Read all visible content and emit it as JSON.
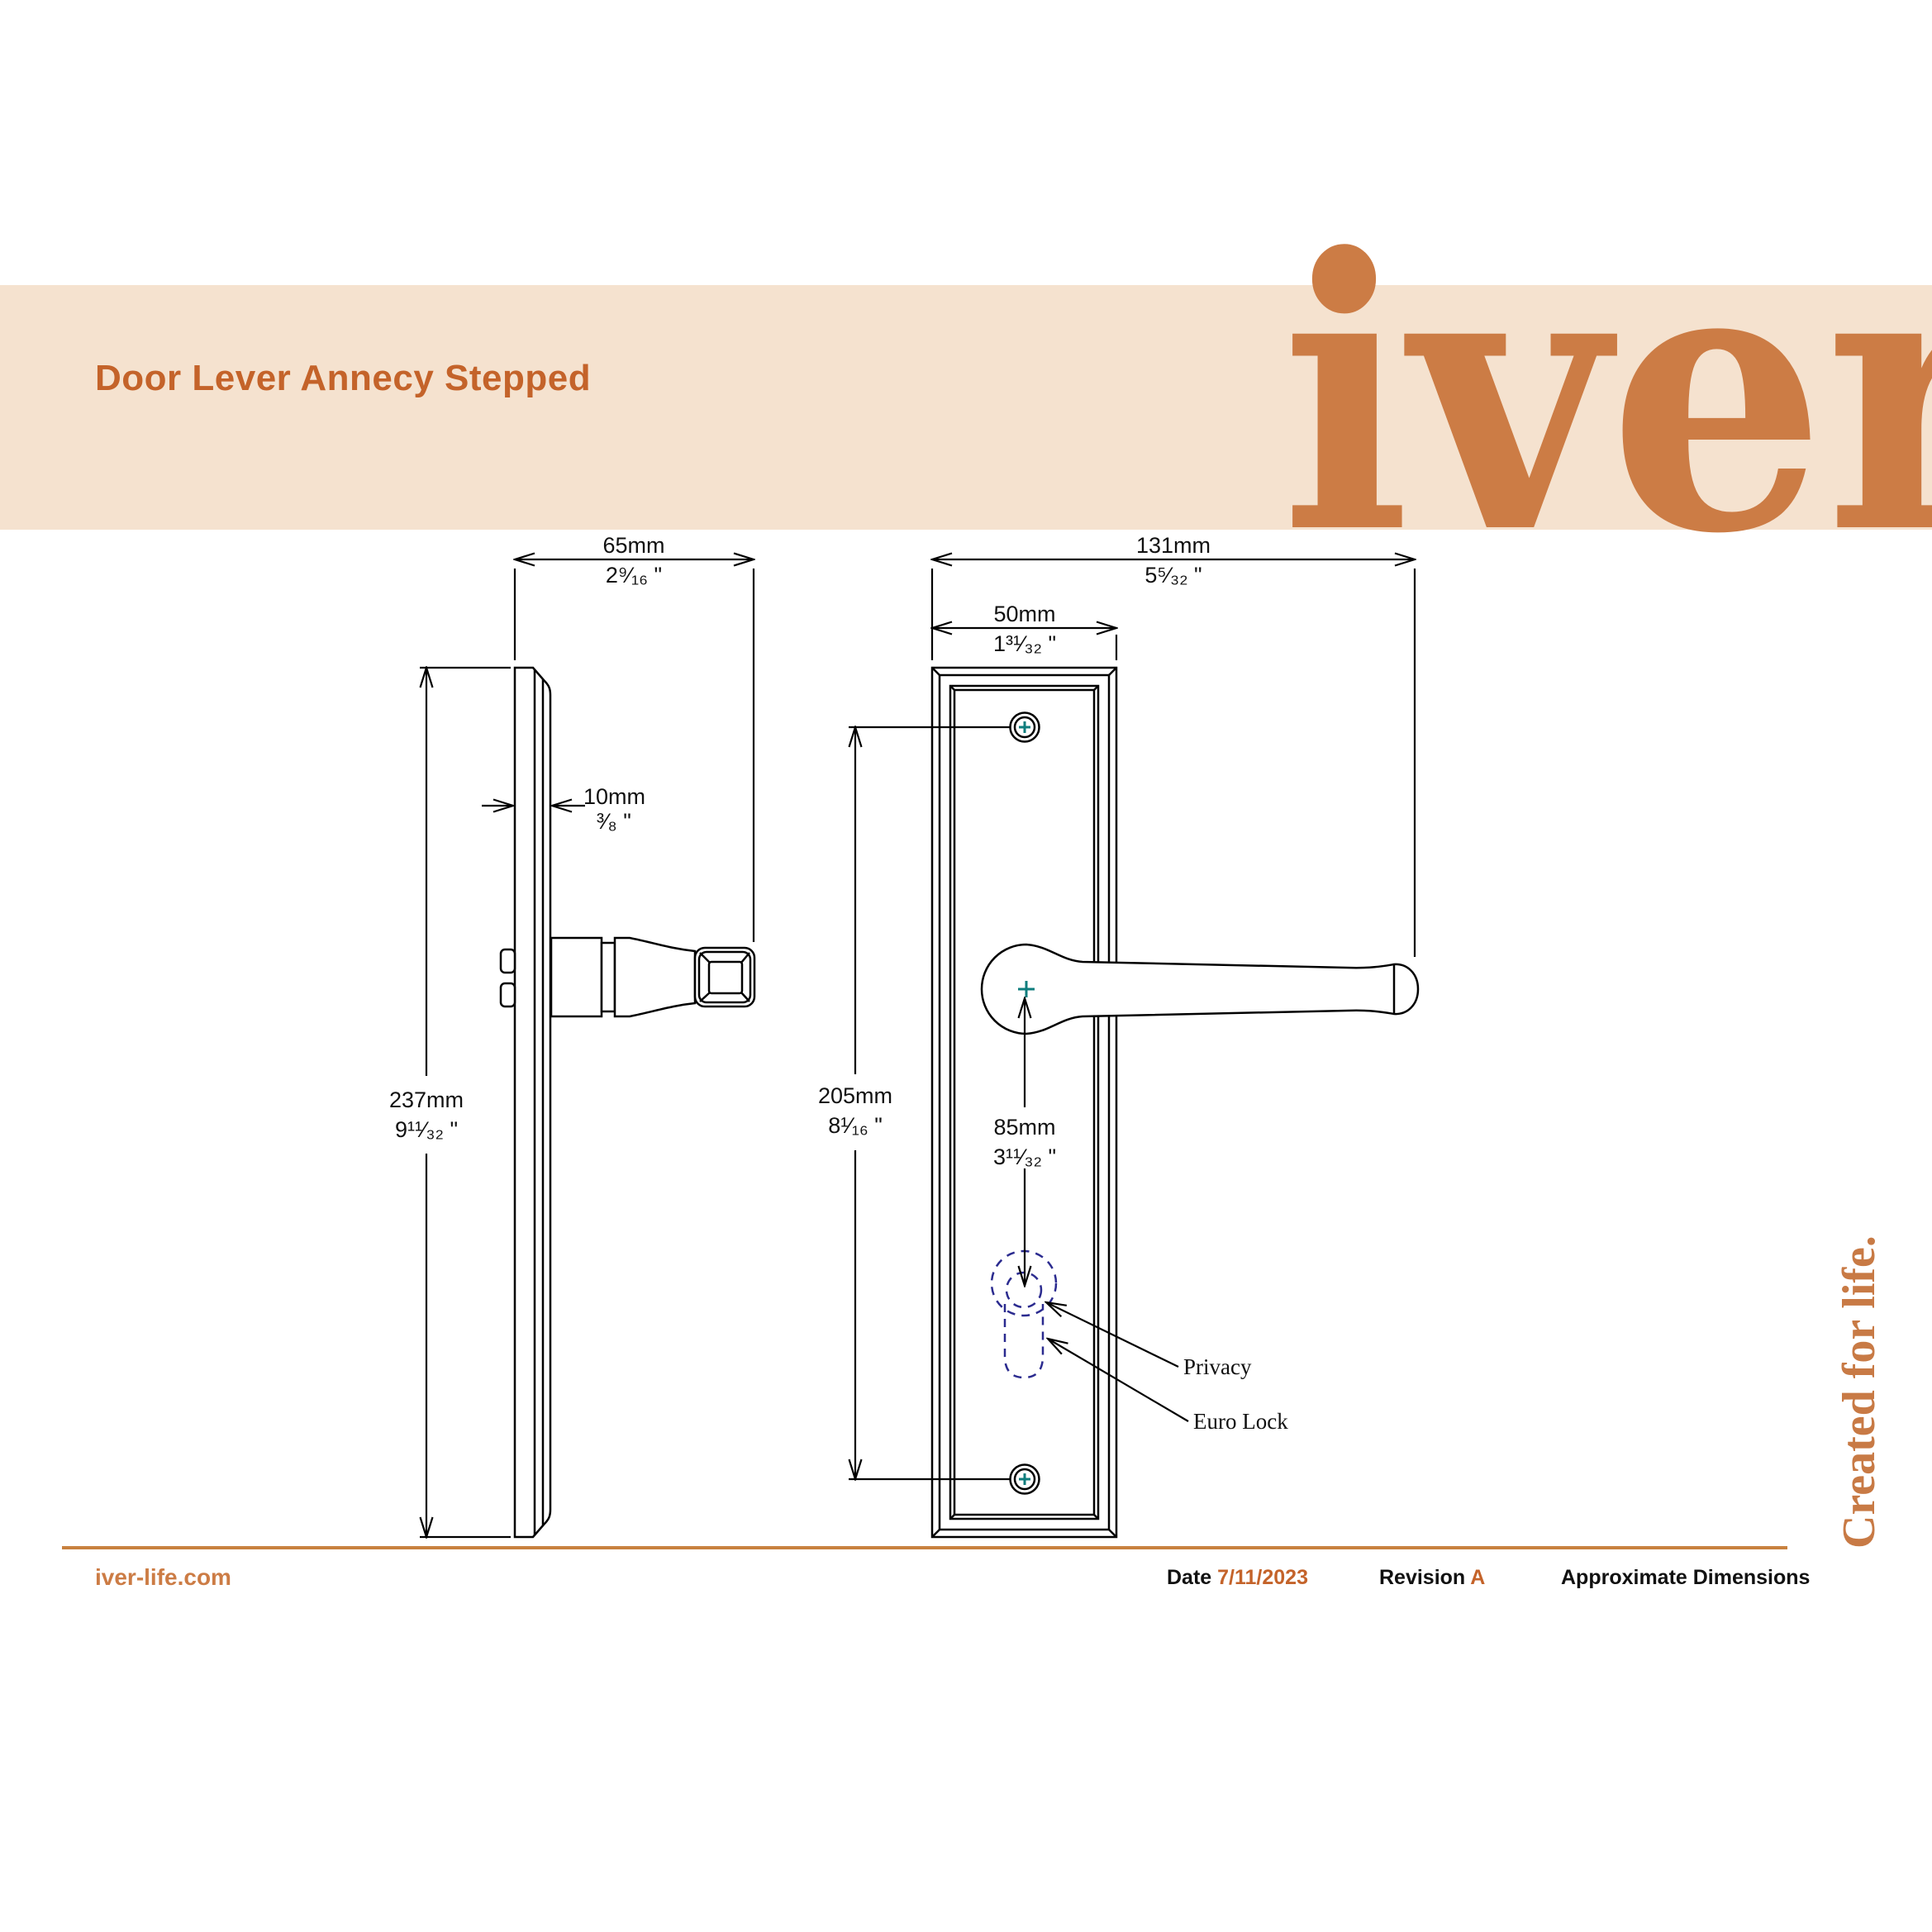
{
  "banner": {
    "title": "Door Lever Annecy Stepped",
    "logo": "iver",
    "bg_color": "#f5e2cf",
    "title_color": "#c4632a",
    "logo_color": "#cc7c45"
  },
  "drawing": {
    "dims": {
      "projection_side": {
        "mm": "65mm",
        "in": "2⁹⁄₁₆ \""
      },
      "total_width": {
        "mm": "131mm",
        "in": "5⁵⁄₃₂ \""
      },
      "plate_width": {
        "mm": "50mm",
        "in": "1³¹⁄₃₂ \""
      },
      "plate_thickness": {
        "mm": "10mm",
        "in": "³⁄₈ \""
      },
      "plate_height": {
        "mm": "237mm",
        "in": "9¹¹⁄₃₂ \""
      },
      "screw_centres": {
        "mm": "205mm",
        "in": "8¹⁄₁₆ \""
      },
      "lever_to_key": {
        "mm": "85mm",
        "in": "3¹¹⁄₃₂ \""
      }
    },
    "labels": {
      "privacy": "Privacy",
      "euro_lock": "Euro Lock"
    },
    "line_color": "#000000",
    "keyhole_dash_color": "#2b2b8f",
    "screw_cross_color": "#0e7d7d"
  },
  "footer": {
    "website": "iver-life.com",
    "date_label": "Date",
    "date_value": "7/11/2023",
    "revision_label": "Revision",
    "revision_value": "A",
    "note": "Approximate Dimensions"
  },
  "side_text": "Created for life."
}
